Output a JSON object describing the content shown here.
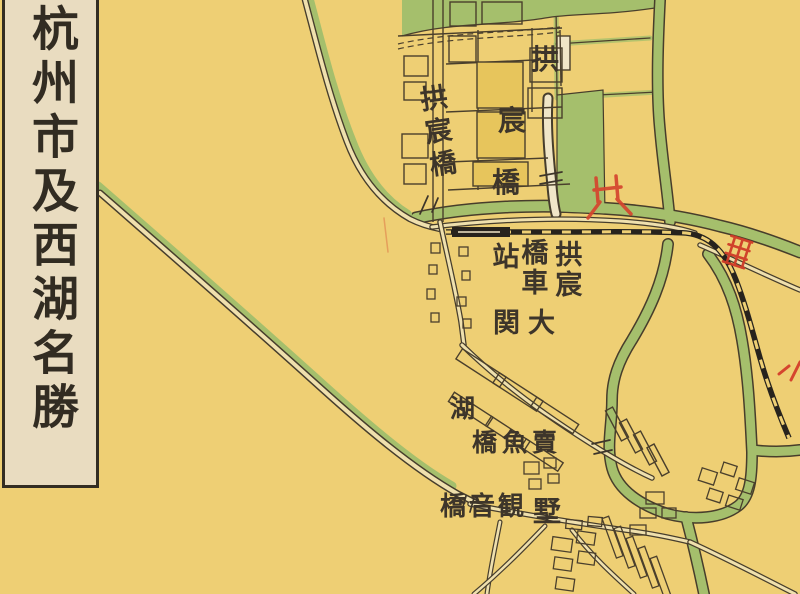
{
  "title": {
    "text": "杭州市及西湖名勝"
  },
  "labels": {
    "gongchen_small": {
      "text": "拱宸橋"
    },
    "gongchen_large": {
      "chars": [
        "拱",
        "宸",
        "橋"
      ]
    },
    "station": {
      "cols": [
        "拱宸",
        "橋車",
        "站"
      ]
    },
    "daguan": {
      "text": "関大"
    },
    "hushu_hu": {
      "text": "湖"
    },
    "maiyu": {
      "text": "橋魚賣"
    },
    "guanyin": {
      "text": "橋音観"
    },
    "hushu_shu": {
      "text": "墅"
    }
  },
  "palette": {
    "paper": "#eecf74",
    "title_box": "#e9dcc0",
    "canal_green": "#a5bf6c",
    "line_ink": "#4a3f2c",
    "casing_ink": "#473d2b",
    "railway_black": "#27231d",
    "channel_cream": "#f0e6c8",
    "block_fill": "#e7c55c",
    "overprint_red": "#d5452e",
    "text_ink": "#3d352a"
  }
}
